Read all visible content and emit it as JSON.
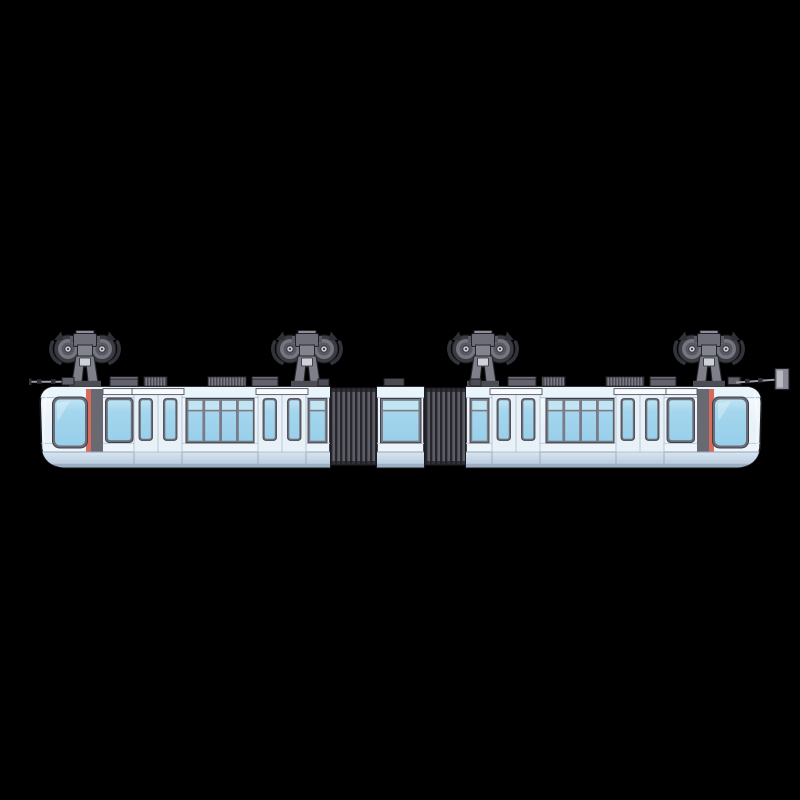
{
  "scene": {
    "title": "Suspended monorail trainset, side view illustration on black background",
    "description": "Side profile of a light-blue and white suspended (hanging) monorail train with two end cars, a short center section joined by two dark accordion gangway bellows, hanging from four twin-wheel bogies. Each cab end has a dark gray and red vertical stripe beside the windshield, passenger doors with narrow windows, four-pane window bands, gray roof equipment boxes, and small antennas at both ends.",
    "background_color": "#000000",
    "object_count": {
      "end_cars": 2,
      "center_sections": 1,
      "gangway_bellows": 2,
      "bogies": 4,
      "wheels_per_bogie": 2,
      "passenger_doors_per_car": 2,
      "panes_per_window_band": 4
    }
  },
  "palette": {
    "bg": "#000000",
    "outline": "#1c1c24",
    "body-top": "#f7fbfe",
    "body-mid": "#e7f1f8",
    "roof-band": "#e9f4fb",
    "roof-line": "#abc2d4",
    "glass-top": "#c2e5f4",
    "glass": "#a4d6ee",
    "glass-deep": "#98cfea",
    "frame": "#6d6d77",
    "mullion": "#7b7b85",
    "frame-edge": "#3f3f48",
    "red-stripe": "#d96a5e",
    "gray-stripe": "#696972",
    "band-top": "#d8e6f1",
    "band-bottom": "#b2c5d8",
    "band-shadow": "#93a6ba",
    "seam": "#9aaec2",
    "sill": "#bccddb",
    "door-panel": "#e9f1f8",
    "door-edge": "#b3c2d1",
    "header": "#f7fbfd",
    "bellows-dark": "#26262c",
    "bellows-light": "#5d5d66",
    "bogie-dark": "#2f2f37",
    "bogie-tire": "#3b3b42",
    "bogie-rim": "#757580",
    "bogie-disc": "#585862",
    "bogie-hub": "#c6c6cf",
    "bogie-mid": "#6e6e78",
    "bogie-arm": "#7f7f89",
    "bogie-arm-hi": "#83838d",
    "bogie-cap": "#8f8f99",
    "bogie-guard": "#33333c",
    "hanger-panel": "#ccd2d8",
    "roofbox": "#62626c",
    "roofbox-top": "#8b8b95",
    "roofbox-dark": "#4c4c55",
    "rib-dark": "#4a4a53",
    "rib-light": "#787882",
    "antenna": "#9a9aa4",
    "marker-panel": "#8a8a94"
  }
}
